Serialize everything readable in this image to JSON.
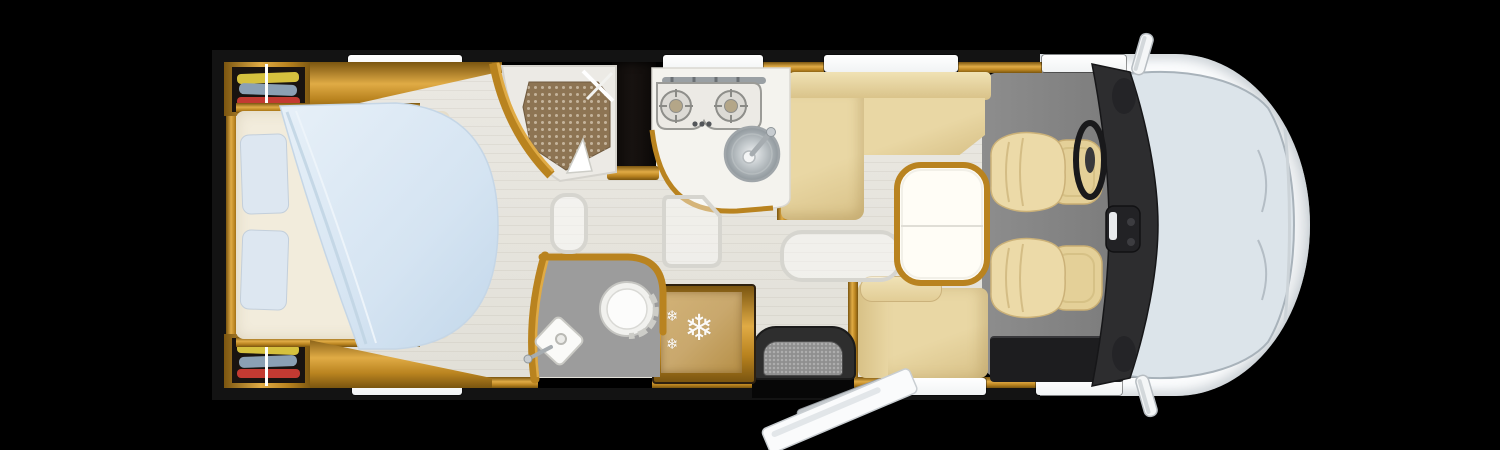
{
  "scene": {
    "type": "motorhome-floorplan-top-view",
    "areas": [
      "bedroom",
      "shower-room",
      "wardrobes",
      "kitchen",
      "washroom",
      "refrigerator",
      "dinette-lounge",
      "entry-step",
      "cab"
    ],
    "furniture": [
      "island-bed",
      "pillows",
      "wardrobe-clothes",
      "shower-mosaic-tray",
      "tall-cabinet",
      "two-burner-hob",
      "kitchen-sink",
      "l-shaped-sofa",
      "side-bench",
      "pedestal-table",
      "refrigerator",
      "toilet",
      "corner-washbasin",
      "entry-door-open",
      "driver-seat",
      "passenger-seat",
      "steering-wheel",
      "dashboard",
      "windshield",
      "side-mirrors",
      "floor-mats"
    ]
  },
  "icons": {
    "snowflake_glyph": "❄"
  },
  "colors": {
    "bg": "#000000",
    "body-wall": "#131313",
    "wood": "#b9831f",
    "wood-light": "#e0ab45",
    "wood-dark": "#7a5510",
    "floor": "#eae8e2",
    "floor-shade": "#e2e0d8",
    "cab-floor": "#8d8d8d",
    "cab-floor-dark": "#787878",
    "upholstery": "#e9d7a4",
    "upholstery-dark": "#d8c187",
    "bed-sheet": "#f2ecdc",
    "pillow": "#dde7f1",
    "duvet": "#d5e4f2",
    "duvet-deep": "#c2d7ea",
    "shower-tile": "#8d7453",
    "shower-tray": "#eceae5",
    "white-goods": "#f4f3ee",
    "steel": "#a6acb0",
    "steel-light": "#c7ccd0",
    "dark-cabinet": "#171210",
    "dashboard": "#2d2d2f",
    "dashboard-deep": "#19191b",
    "windshield": "#dce4ea",
    "cab-body": "#fbfcfd",
    "window": "#ffffff",
    "wardrobe-interior": "#191310",
    "clothes-yellow": "#d6c13e",
    "clothes-blue": "#8ba0b4",
    "clothes-red": "#c33a32",
    "fridge": "#c9a86d",
    "toilet-floor": "#9c9c9c",
    "sideboard": "#1d1d1f",
    "step-well": "#2e2e2e",
    "step": "#8f8f8f",
    "door-leaf": "#fafbfc",
    "mat-line": "#d6d5cf",
    "table-top": "#fffdf6"
  }
}
